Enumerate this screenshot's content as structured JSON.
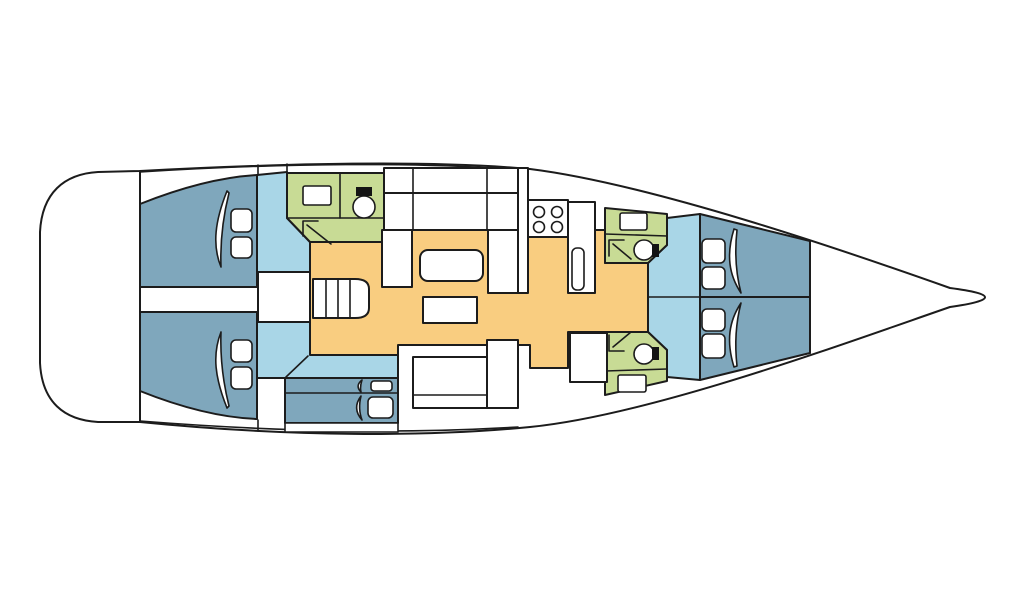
{
  "plan": {
    "kind": "sailing-yacht-deck-plan",
    "orientation": "bow-right-stern-left"
  },
  "colors": {
    "background": "#ffffff",
    "outline": "#1c1c1c",
    "hull": "#ffffff",
    "cabin": "#7fa7bc",
    "passage": "#a9d6e7",
    "head": "#c8db95",
    "floor": "#f9cd80",
    "furniture": "#ffffff",
    "toilet_tank": "#141414"
  },
  "regions": {
    "stern_platform": "stern platform",
    "aft_cabin_port": "aft cabin port",
    "aft_cabin_starboard": "aft cabin starboard",
    "aft_head": "aft head with shower",
    "companionway_stairs": "companionway stairs",
    "salon": "salon with settee and table",
    "galley": "galley with stove",
    "bunk_cabin": "bunk cabin",
    "nav_station": "nav station seats",
    "fwd_head_port": "forward head port",
    "fwd_head_starboard": "forward head starboard",
    "fwd_cabin_port": "forward cabin port",
    "fwd_cabin_starboard": "forward cabin starboard",
    "bow_locker": "bow locker"
  },
  "icons": {
    "toilet": "toilet-icon",
    "sink": "sink-icon",
    "shower": "shower-arrow-icon",
    "stove": "stove-burners-icon",
    "stairs": "stairs-icon",
    "pillow": "pillow-icon",
    "blanket": "blanket-fold-icon",
    "table": "table-icon"
  }
}
